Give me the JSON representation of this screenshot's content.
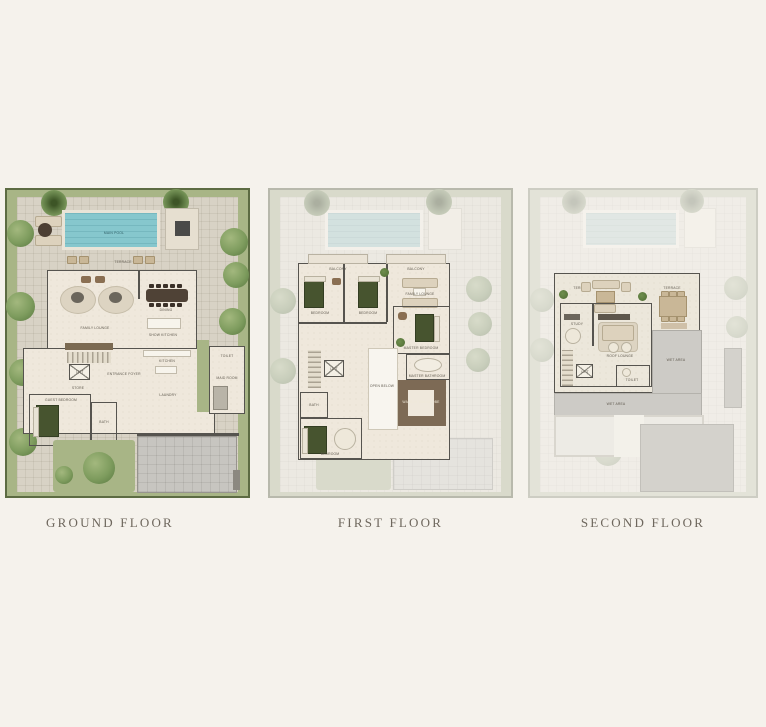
{
  "page": {
    "background": "#f5f2ec"
  },
  "captions": {
    "ground": "GROUND FLOOR",
    "first": "FIRST FLOOR",
    "second": "SECOND FLOOR"
  },
  "colors": {
    "garden": "#a8b586",
    "garden_border": "#5c6b42",
    "paving": "#d8d2c5",
    "pool": "#86c7cd",
    "interior": "#efe8dc",
    "wall": "#56544f",
    "bed_green": "#47542f",
    "wood": "#b59a74",
    "dining_table": "#4f4236",
    "driveway": "#c7c5c0",
    "wardrobe_brown": "#7d6a55",
    "roof_gray": "#d4d2cc",
    "caption_text": "#6e675d"
  },
  "ground_floor": {
    "labels": {
      "main_pool": "MAIN POOL",
      "terrace": "TERRACE",
      "family_lounge": "FAMILY LOUNGE",
      "dining": "DINING",
      "show_kitchen": "SHOW KITCHEN",
      "entrance_foyer": "ENTRANCE FOYER",
      "store": "STORE",
      "lift": "LIFT",
      "guest_bedroom": "GUEST BEDROOM",
      "bath": "BATH",
      "kitchen": "KITCHEN",
      "laundry": "LAUNDRY",
      "toilet": "TOILET",
      "maid_room": "MAID ROOM"
    }
  },
  "first_floor": {
    "labels": {
      "balcony": "BALCONY",
      "bedroom": "BEDROOM",
      "family_lounge": "FAMILY LOUNGE",
      "master_bedroom": "MASTER BEDROOM",
      "master_bathroom": "MASTER BATHROOM",
      "walk_in_wardrobe": "WALK-IN WARDROBE",
      "open_below": "OPEN BELOW",
      "bath": "BATH",
      "lift": "LIFT"
    }
  },
  "second_floor": {
    "labels": {
      "terrace": "TERRACE",
      "study": "STUDY",
      "roof_lounge": "ROOF LOUNGE",
      "toilet": "TOILET",
      "lift": "LIFT",
      "wet_area": "WET AREA"
    }
  }
}
